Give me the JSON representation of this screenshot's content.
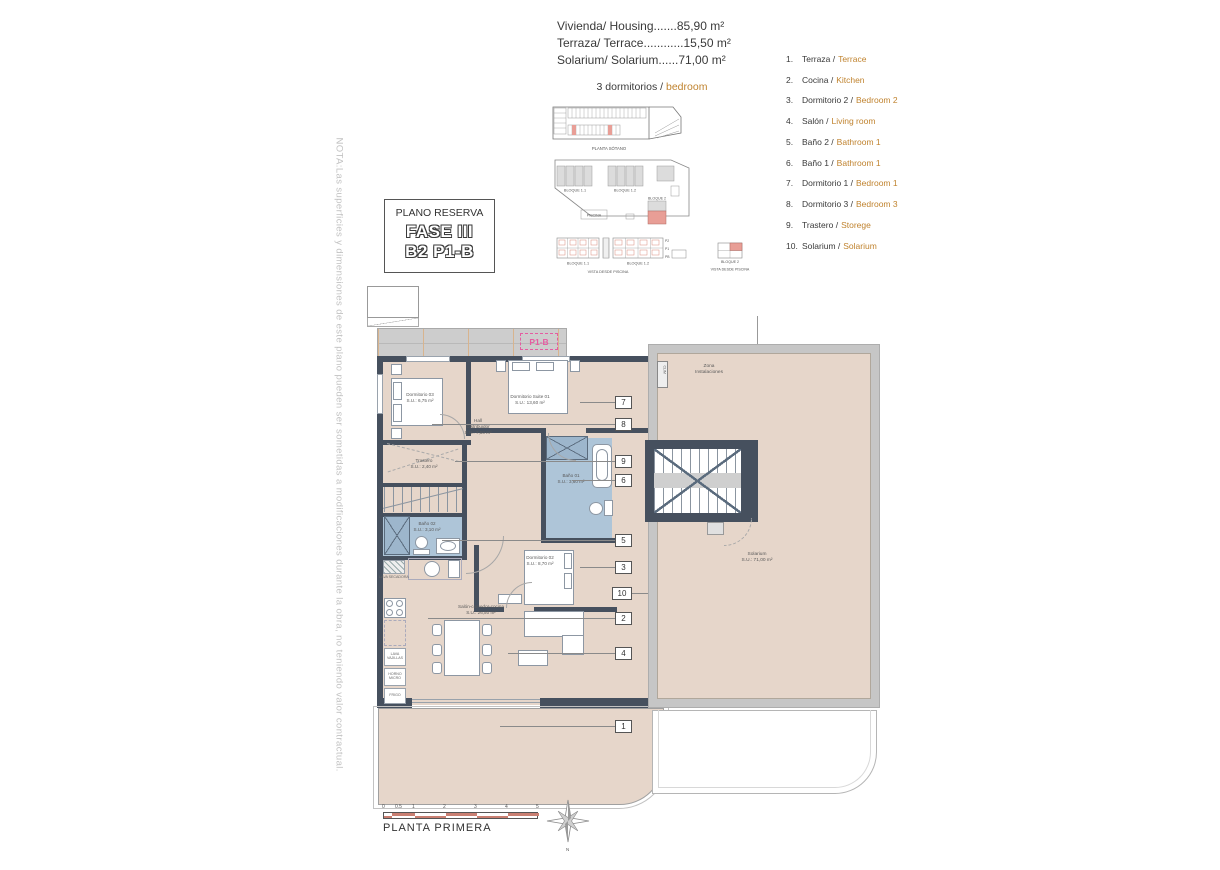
{
  "header": {
    "line1": "Vivienda/ Housing.......85,90 m²",
    "line2": "Terraza/ Terrace............15,50 m²",
    "line3": "Solarium/ Solarium......71,00 m²",
    "bedrooms_es": "3 dormitorios /",
    "bedrooms_en": "bedroom"
  },
  "legend": {
    "items": [
      {
        "n": "1.",
        "es": "Terraza /",
        "en": "Terrace"
      },
      {
        "n": "2.",
        "es": "Cocina /",
        "en": "Kitchen"
      },
      {
        "n": "3.",
        "es": "Dormitorio 2 /",
        "en": "Bedroom 2"
      },
      {
        "n": "4.",
        "es": "Salón /",
        "en": "Living room"
      },
      {
        "n": "5.",
        "es": "Baño 2 /",
        "en": "Bathroom 1"
      },
      {
        "n": "6.",
        "es": "Baño 1 /",
        "en": "Bathroom 1"
      },
      {
        "n": "7.",
        "es": "Dormitorio 1 /",
        "en": "Bedroom 1"
      },
      {
        "n": "8.",
        "es": "Dormitorio 3 /",
        "en": "Bedroom 3"
      },
      {
        "n": "9.",
        "es": "Trastero /",
        "en": "Storege"
      },
      {
        "n": "10.",
        "es": "Solarium /",
        "en": "Solarium"
      }
    ]
  },
  "note": "NOTA:Las superficies y dimensiones de este plano pueden ser sometidas a modificaciones durante la obra, no teniendo valor contractual.",
  "title_box": {
    "title": "PLANO RESERVA",
    "phase": "FASE III",
    "unit": "B2 P1-B"
  },
  "site": {
    "sotano": "PLANTA SÓTANO",
    "bloque11": "BLOQUE 1.1",
    "bloque12": "BLOQUE 1.2",
    "bloque2": "BLOQUE 2",
    "bloque2_elev": "BLOQUE 2",
    "piscina": "PISCINA",
    "vista1": "VISTA DESDE PISCINA",
    "vista2": "VISTA DESDE PISCINA",
    "p2": "P2",
    "p1": "P1",
    "pb": "PB"
  },
  "plan": {
    "tag": "P1-B",
    "rooms": {
      "d03": {
        "name": "Dormitorio 03",
        "area": "S.U.: 6,75 m²"
      },
      "suite": {
        "name": "Dormitorio Suite 01",
        "area": "S.U.: 13,60 m²"
      },
      "hall": {
        "name": "Hall",
        "name2": "Distribuidor",
        "area": "S.U.: 7,50 m²"
      },
      "trastero": {
        "name": "Trastero",
        "area": "S.U.: 2,40 m²"
      },
      "bano1": {
        "name": "Baño 01",
        "area": "S.U.: 3,60 m²"
      },
      "bano2": {
        "name": "Baño 02",
        "area": "S.U.: 3,10 m²"
      },
      "d02": {
        "name": "Dormitorio 02",
        "area": "S.U.: 8,70 m²"
      },
      "salon": {
        "name": "Salón-comedor-cocina",
        "area": "S.U.: 26,50 m²"
      },
      "terraza": {
        "name": "Terraza",
        "area": "S.U.: 20,50 m²"
      }
    },
    "kitchen": [
      "LAVA SECADORA",
      "LAVA VAJILLAS",
      "HORNO MICRO",
      "FRIGO"
    ],
    "callouts": [
      "7",
      "8",
      "9",
      "6",
      "5",
      "3",
      "10",
      "2",
      "4",
      "1"
    ]
  },
  "solarium": {
    "zona_line1": "Zona",
    "zona_line2": "Instalaciones",
    "clim": "CLIM",
    "name": "Solarium",
    "area": "S.U.: 71,00 m²"
  },
  "footer": {
    "ticks": [
      "0",
      "0.5",
      "1",
      "2",
      "3",
      "4",
      "5"
    ],
    "plan_name": "PLANTA PRIMERA",
    "north_label": "N"
  },
  "colors": {
    "accent_orange": "#c0832f",
    "wall": "#46505e",
    "floor": "#e6d6ca",
    "bath_floor": "#aec5d8",
    "frame_gray": "#c6c6c6",
    "highlight_pink": "#e89e96",
    "tag_magenta": "#e55ca1",
    "scalebar_red": "#c97f72"
  }
}
